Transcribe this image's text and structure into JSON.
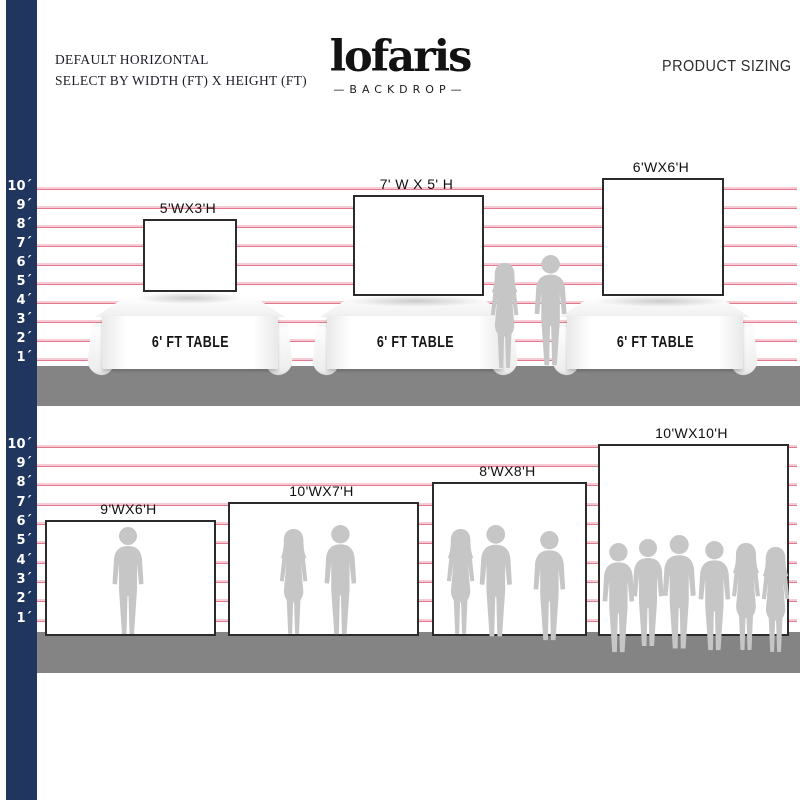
{
  "header": {
    "title_line1": "DEFAULT HORIZONTAL",
    "title_line2": "SELECT BY WIDTH (FT) X HEIGHT (FT)",
    "brand": {
      "name": "lofaris",
      "tagline": "—BACKDROP—"
    },
    "page_label": "PRODUCT SIZING"
  },
  "ruler": {
    "unit": "ft",
    "ticks": [
      "10´",
      "9´",
      "8´",
      "7´",
      "6´",
      "5´",
      "4´",
      "3´",
      "2´",
      "1´"
    ]
  },
  "table_section": {
    "table_label": "6' FT TABLE",
    "backdrops": [
      {
        "size_label": "5'WX3'H"
      },
      {
        "size_label": "7' W X 5' H"
      },
      {
        "size_label": "6'WX6'H"
      }
    ]
  },
  "floor_section": {
    "backdrops": [
      {
        "size_label": "9'WX6'H"
      },
      {
        "size_label": "10'WX7'H"
      },
      {
        "size_label": "8'WX8'H"
      },
      {
        "size_label": "10'WX10'H"
      }
    ]
  },
  "colors": {
    "ruler_bar": "#21365e",
    "grid_line": "#e2798f",
    "ground": "#848484",
    "silhouette": "#c6c6c6",
    "backdrop_border": "#2b2b2b"
  }
}
